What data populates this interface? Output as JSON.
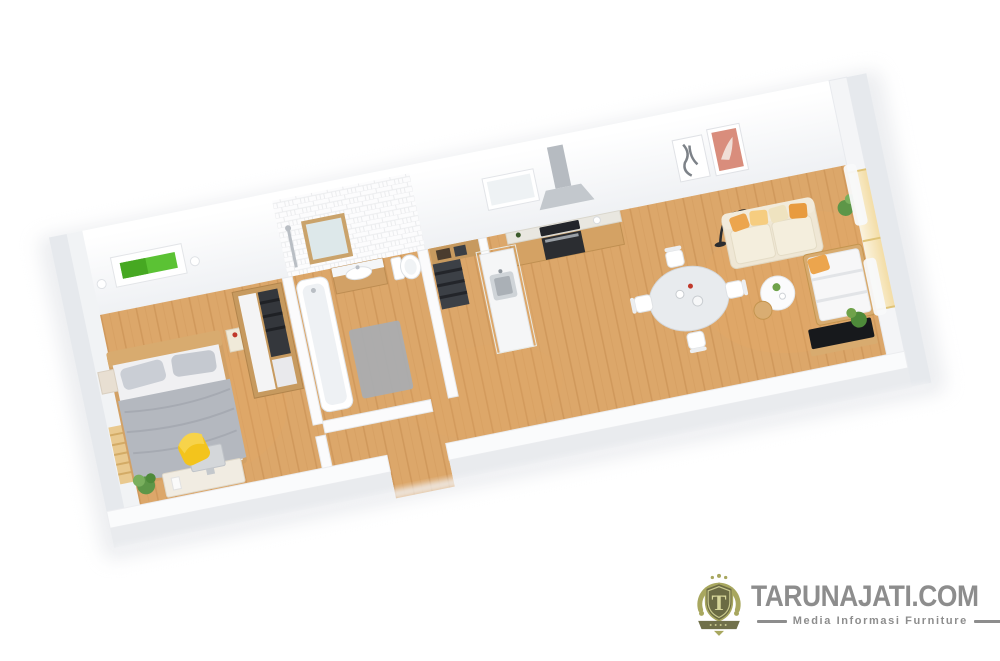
{
  "watermark": {
    "title": "TARUNAJATI.COM",
    "subtitle": "Media Informasi Furniture",
    "emblem_letter": "T",
    "colors": {
      "text": "#8d8d8d",
      "emblem_olive": "#a8a75f",
      "emblem_dark": "#6b6b44"
    }
  },
  "scene": {
    "type": "isometric-3d-floor-plan-render",
    "description": "Long narrow apartment 3D floor plan viewed at an angle, white walls and warm wood floor",
    "rooms": [
      {
        "name": "bedroom",
        "items": [
          "double-bed-gray",
          "wood-headboard",
          "nightstand-left",
          "nightstand-right",
          "green-wall-art",
          "wall-lamps",
          "open-wardrobe",
          "desk-with-monitor",
          "yellow-chair",
          "potted-plant",
          "radiator"
        ]
      },
      {
        "name": "bathroom",
        "items": [
          "bathtub",
          "vanity-sink",
          "framed-mirror",
          "toilet",
          "gray-bath-mat",
          "shower-column",
          "white-tiled-wall"
        ]
      },
      {
        "name": "hallway-closet",
        "items": [
          "open-closet-dark-clothes",
          "storage-shelf-boxes",
          "entrance-doorway"
        ]
      },
      {
        "name": "kitchen",
        "items": [
          "l-shaped-counter",
          "black-oven-cooktop",
          "range-hood-chimney",
          "island-with-sink",
          "kitchen-window"
        ]
      },
      {
        "name": "dining-area",
        "items": [
          "round-white-table",
          "white-chairs-x4"
        ]
      },
      {
        "name": "living-area",
        "items": [
          "cream-sofa",
          "orange-yellow-pillows",
          "black-arc-floor-lamp",
          "round-coffee-table-white",
          "round-side-table-wood",
          "framed-art-map",
          "framed-art-pink",
          "daybed-white-mattress",
          "black-tv-low-bench",
          "curtained-window",
          "green-plants"
        ]
      }
    ],
    "palette": {
      "background": "#ffffff",
      "floor_wood": "#dca76a",
      "floor_wood_dark": "#cd9659",
      "wall_white": "#f7f8fa",
      "wall_shadow": "#e8eaee",
      "bed_gray": "#b4b8bf",
      "accent_green": "#5bc234",
      "accent_yellow": "#f3c41c",
      "sofa_cream": "#efe7d5",
      "pillow_orange": "#eca54d",
      "tv_black": "#17191c",
      "wood_furniture": "#d8ab6f"
    }
  }
}
